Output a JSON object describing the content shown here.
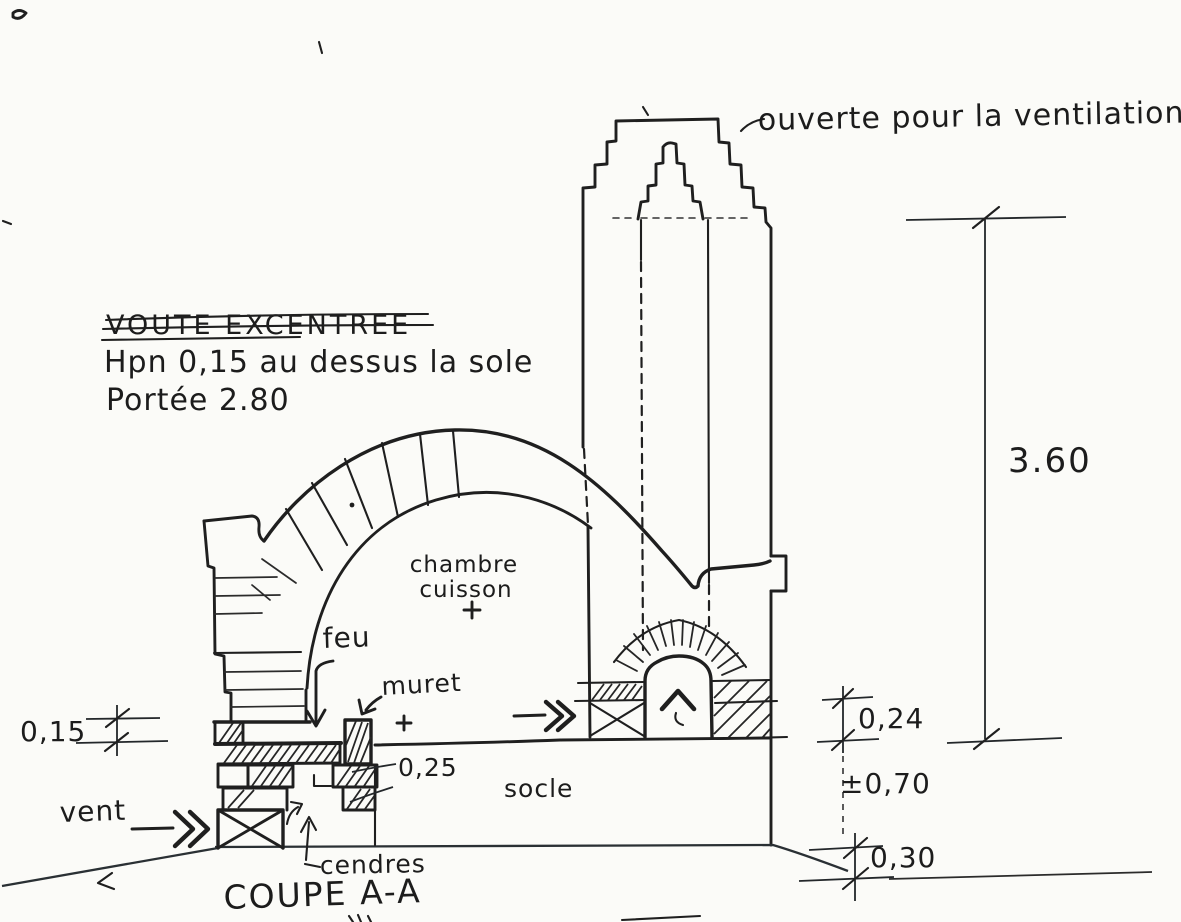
{
  "annotations": {
    "ventilation": "ouverte pour la ventilation",
    "vault_title": "VOUTE EXCENTREE",
    "vault_line2": "Hpn 0,15 au dessus la sole",
    "vault_line3": "Portée 2.80",
    "chamber_line1": "chambre",
    "chamber_line2": "cuisson",
    "fire": "feu",
    "muret": "muret",
    "socle": "socle",
    "vent": "vent",
    "cendres": "cendres",
    "section_title": "COUPE A-A"
  },
  "dimensions": {
    "sole_offset_left": "0,15",
    "hearth_step": "0,25",
    "sole_thickness": "0,24",
    "socle_height": "±0,70",
    "ground_course": "0,30",
    "overall_height": "3.60"
  },
  "colors": {
    "ink": "#1f1f1f",
    "paper": "#fbfbf8"
  }
}
